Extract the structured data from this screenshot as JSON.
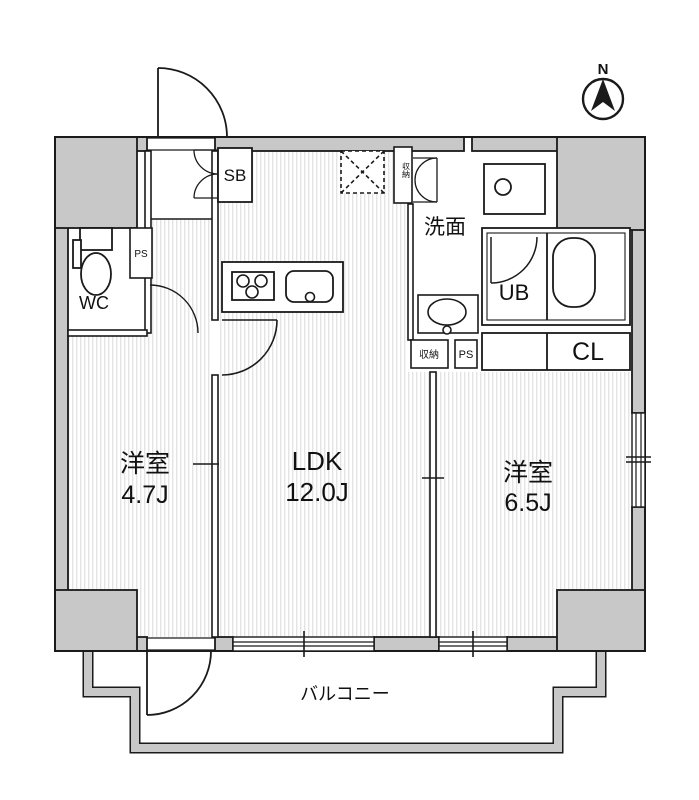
{
  "compass": {
    "north_label": "N"
  },
  "rooms": {
    "bedroom_left": {
      "name": "洋室",
      "size": "4.7J"
    },
    "living": {
      "name": "LDK",
      "size": "12.0J"
    },
    "bedroom_right": {
      "name": "洋室",
      "size": "6.5J"
    }
  },
  "labels": {
    "washroom": "洗面",
    "unit_bath": "UB",
    "closet": "CL",
    "toilet": "WC",
    "shoe_box": "SB",
    "pipe_space_entry": "PS",
    "pipe_space_corner": "PS",
    "storage_cabinet": "収納",
    "storage_box": "収納",
    "balcony": "バルコニー"
  },
  "colors": {
    "wall_fill": "#c8c8c8",
    "line": "#1a1a1a",
    "floor_stripe": "#d9d9d9"
  }
}
